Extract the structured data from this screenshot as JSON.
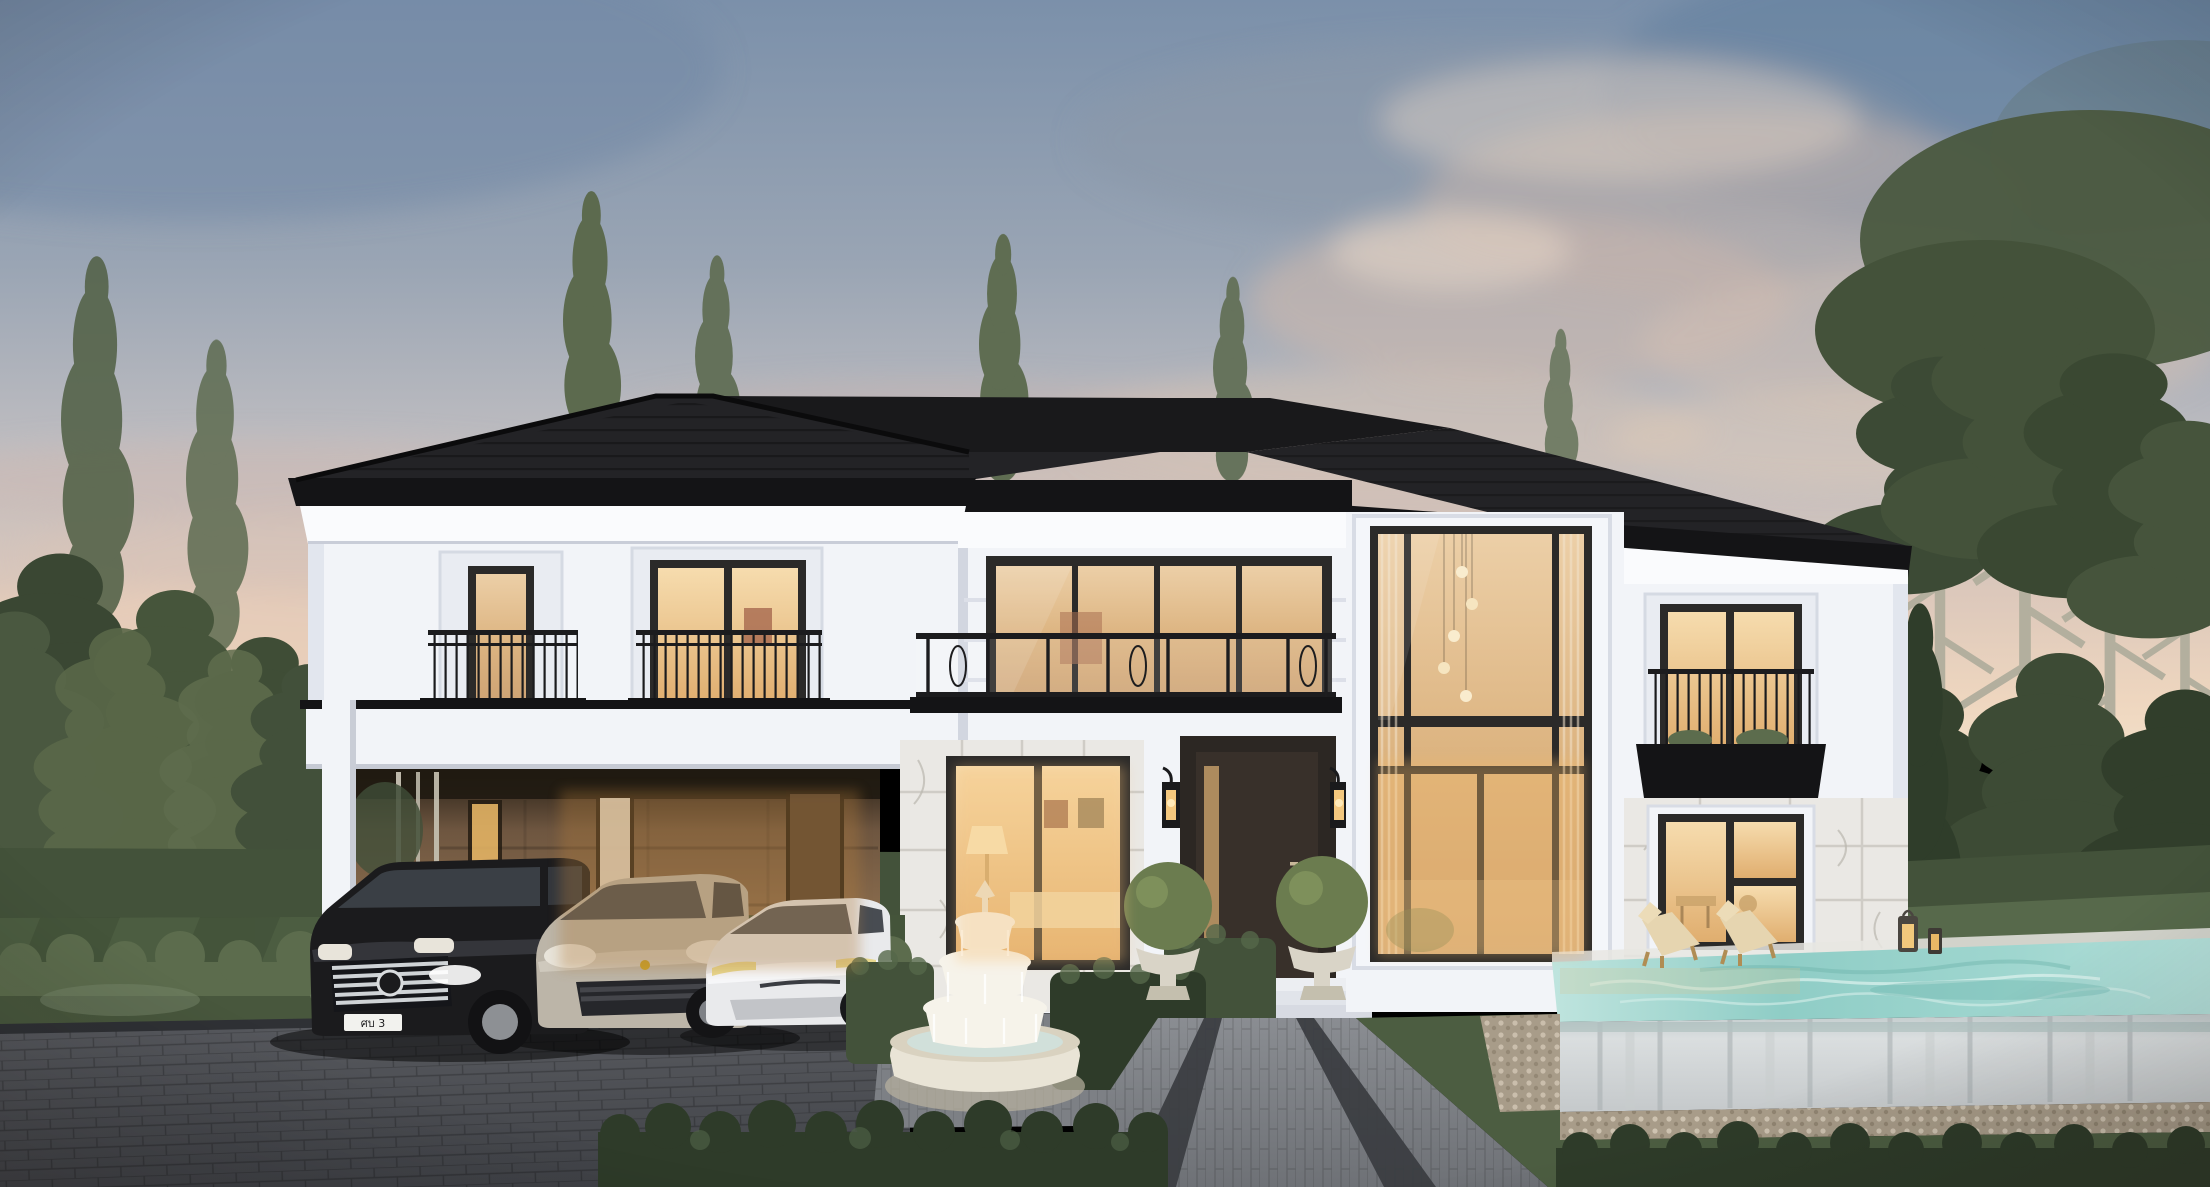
{
  "scene": {
    "description": "Twilight exterior rendering of a luxury two-storey modern-classic villa",
    "license_plate": "ศบ 3",
    "objects": [
      "hip-roof",
      "white-facade",
      "carport",
      "black-minivan",
      "beige-suv",
      "white-sedan",
      "front-door",
      "wall-lanterns",
      "topiary-urns",
      "tiered-fountain",
      "double-height-window",
      "juliet-balconies",
      "glass-balcony",
      "infinity-pool",
      "lounge-chairs",
      "candle-lanterns",
      "boxwood-hedges",
      "lawn",
      "paver-driveway",
      "paver-walkway",
      "pine-forest",
      "sunset-sky"
    ]
  },
  "palette": {
    "sky_top": "#7b90aa",
    "sky_mid": "#afb3bc",
    "sky_horizon": "#f0dac2",
    "cloud_warm": "#d8c2b4",
    "cloud_blue": "#6e86a4",
    "roof": "#232326",
    "roof_dark": "#19191b",
    "fascia": "#141416",
    "facade": "#f2f4f8",
    "facade_shadow": "#e2e6ee",
    "cornice": "#fafbfd",
    "trim_black": "#1c1c1e",
    "frame_black": "#2b2a29",
    "glass_warm": "#e2be8c",
    "glass_bright": "#f3d4a0",
    "carport_wall": "#8a6c4d",
    "carport_dark": "#2a2118",
    "door": "#38302a",
    "marble": "#eae8e4",
    "marble_vein": "#b9b6ae",
    "stone_urn": "#d9d4c7",
    "topiary": "#6b7c4f",
    "hedge_dark": "#2e3b29",
    "hedge_mid": "#43523a",
    "hedge_light": "#5c6c4d",
    "lawn": "#4c5d41",
    "lawn_light": "#57694b",
    "forest": "#42503a",
    "forest_light": "#5a684c",
    "trunk": "#b5b1a0",
    "water": "#8fcdc6",
    "water_light": "#c8e9e4",
    "pool_face": "#d6d9db",
    "pebble": "#a89c89",
    "driveway": "#55575c",
    "driveway_dark": "#3e4045",
    "walkway": "#7b7e83",
    "walkway_strip": "#3a3c40",
    "car_van": "#1b1b1d",
    "car_suv": "#bcb5a8",
    "car_tesla": "#e9eaec",
    "chrome": "#d9dcde",
    "fountain_stone": "#e9e4d6",
    "fountain_water": "#f6f3ea",
    "interior_glow": "#f0c684"
  }
}
